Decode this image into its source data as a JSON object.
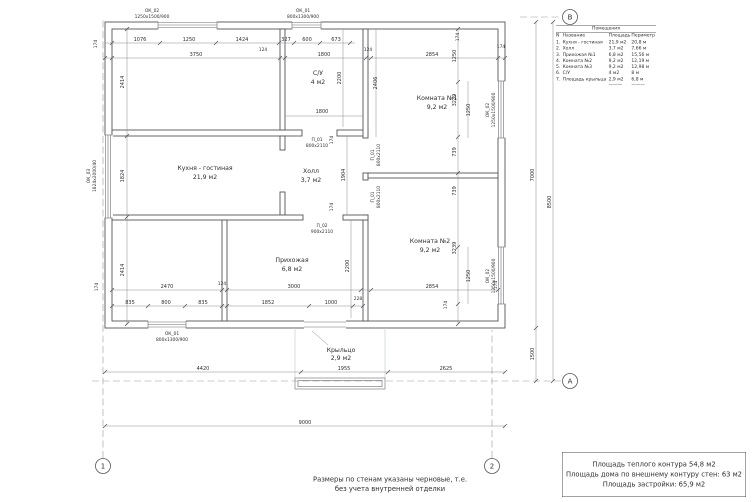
{
  "legend": {
    "title": "Помещения",
    "col_n": "N",
    "col_name": "Название",
    "col_area": "Площадь",
    "col_perimeter": "Периметр",
    "rows": [
      {
        "n": "1.",
        "name": "Кухня - гостиная",
        "area": "21,9 м2",
        "perimeter": "20,8 м"
      },
      {
        "n": "2.",
        "name": "Холл",
        "area": "3,7 м2",
        "perimeter": "7,66 м"
      },
      {
        "n": "3.",
        "name": "Прихожая №1",
        "area": "6,8 м2",
        "perimeter": "15,56 м"
      },
      {
        "n": "4.",
        "name": "Комната №2",
        "area": "9,2 м2",
        "perimeter": "12,19 м"
      },
      {
        "n": "5.",
        "name": "Комната №3",
        "area": "9,2 м2",
        "perimeter": "12,98 м"
      },
      {
        "n": "6.",
        "name": "С/У",
        "area": "4 м2",
        "perimeter": "8 м"
      },
      {
        "n": "7.",
        "name": "Площадь крыльца",
        "area": "2,9 м2",
        "perimeter": "6,8 м"
      }
    ],
    "dash": "———"
  },
  "rooms": {
    "kitchen": {
      "name": "Кухня - гостиная",
      "area": "21,9 м2"
    },
    "wc": {
      "name": "С/У",
      "area": "4 м2"
    },
    "room1": {
      "name": "Комната №1",
      "area": "9,2 м2"
    },
    "hall": {
      "name": "Холл",
      "area": "3,7 м2"
    },
    "room2": {
      "name": "Комната №2",
      "area": "9,2 м2"
    },
    "entry": {
      "name": "Прихожая",
      "area": "6,8 м2"
    },
    "porch": {
      "name": "Крыльцо",
      "area": "2,9 м2"
    }
  },
  "openings": {
    "ok01": "ОК_01",
    "ok01_size": "800х1300/900",
    "ok02": "ОК_02",
    "ok02_size": "1250х1500/900",
    "ok03": "ОК_03",
    "ok03_size": "1824х2000/40",
    "p01": "П_01",
    "p01_size": "800х2110",
    "p02": "П_02",
    "p02_size": "900х2110"
  },
  "dims": {
    "top1": [
      "1076",
      "1250",
      "1424",
      "327",
      "600",
      "673"
    ],
    "top2": [
      "3750",
      "1800",
      "2854"
    ],
    "bottom1": [
      "2470",
      "3000",
      "2854"
    ],
    "bottom2": [
      "835",
      "800",
      "835",
      "1852",
      "1000",
      "228"
    ],
    "bottom_out": [
      "4420",
      "1955",
      "2625"
    ],
    "left": [
      "2414",
      "1824",
      "2414"
    ],
    "right_col": [
      "1250",
      "3239",
      "1250",
      "739",
      "739",
      "3239",
      "1250"
    ],
    "right_out": [
      "7000",
      "8500",
      "1500"
    ],
    "misc": {
      "su_h": "2200",
      "su_w": "1800",
      "hall_h": "1904",
      "entry_h": "2200",
      "k1_left": "2406",
      "total": "9000",
      "t174": "174",
      "t124": "124"
    }
  },
  "grid": {
    "a": "А",
    "b": "В",
    "n1": "1",
    "n2": "2"
  },
  "notes": {
    "line1": "Размеры по стенам указаны черновые, т.е.",
    "line2": "без учета внутренней отделки"
  },
  "summary": {
    "line1": "Площадь теплого контура 54,8 м2",
    "line2": "Площадь дома по внешнему контуру стен: 63 м2",
    "line3": "Площадь застройки: 65,9 м2"
  }
}
